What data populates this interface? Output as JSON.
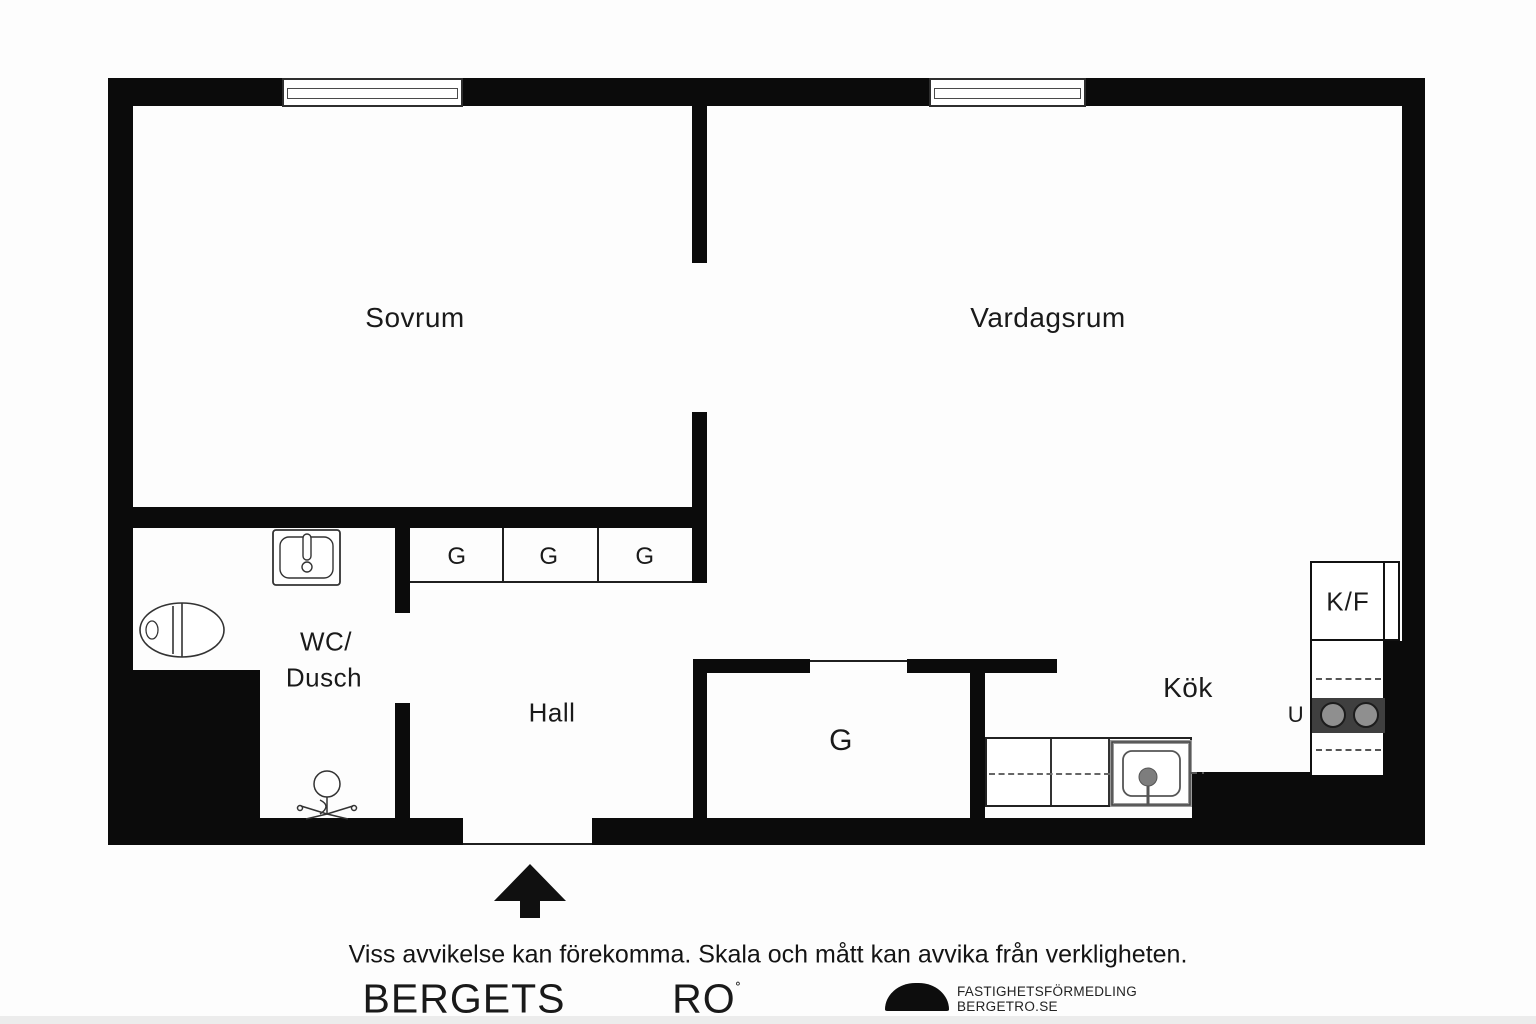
{
  "plan": {
    "wall_color": "#0b0b0b",
    "floor_color": "#ffffff",
    "stove_color": "#3f3f3f"
  },
  "rooms": {
    "bedroom": {
      "label": "Sovrum"
    },
    "living": {
      "label": "Vardagsrum"
    },
    "bath_line1": "WC/",
    "bath_line2": "Dusch",
    "hall": {
      "label": "Hall"
    },
    "kitchen": {
      "label": "Kök"
    }
  },
  "closets": {
    "small": [
      "G",
      "G",
      "G"
    ],
    "large": "G"
  },
  "appliances": {
    "fridge_freezer": "K/F",
    "oven": "U"
  },
  "icons": [
    "toilet-icon",
    "washbasin-icon",
    "shower-mixer-icon",
    "kitchen-sink-icon",
    "stove-burners",
    "entrance-arrow-icon",
    "window",
    "logo-dome-icon"
  ],
  "footer": {
    "disclaimer": "Viss avvikelse kan förekomma. Skala och mått kan avvika från verkligheten.",
    "brand_word1": "BERGETS",
    "brand_word2": "RO",
    "brand_degree": "˚",
    "tagline_line1": "FASTIGHETSFÖRMEDLING",
    "tagline_line2": "BERGETRO.SE"
  }
}
